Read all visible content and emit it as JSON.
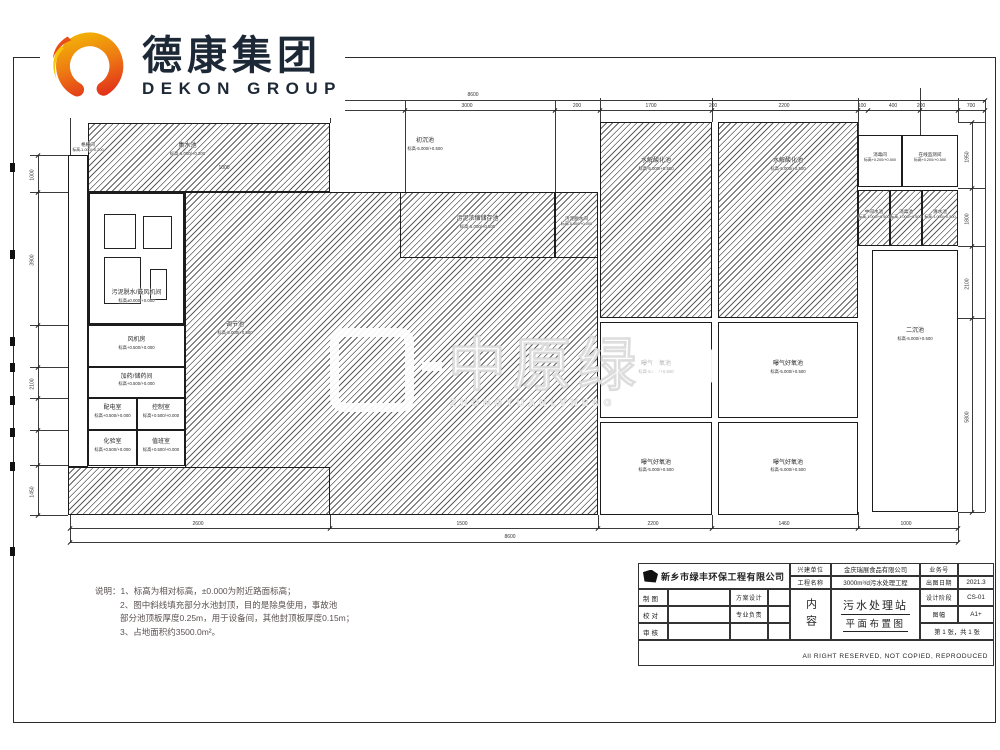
{
  "logo": {
    "cn": "德康集团",
    "en": "DEKON GROUP"
  },
  "watermark": {
    "big": "中原绿",
    "sub": "ZHONGYUANLVNENG"
  },
  "notes": {
    "line1": "说明：1、标高为相对标高，±0.000为附近路面标高；",
    "line2": "2、图中斜线填充部分水池封顶，目的是除臭使用，事故池",
    "line3": "部分池顶板厚度0.25m，用于设备间，其他封顶板厚度0.15m；",
    "line4": "3、占地面积约3500.0m²。"
  },
  "titleblock": {
    "design_company": "新乡市绿丰环保工程有限公司",
    "owner_label": "兴建单位",
    "owner_value": "金庆瑞展食品有限公司",
    "project_label": "工程名称",
    "project_value": "3000m³/d污水处理工程",
    "jobno_label": "业务号",
    "jobno_value": "",
    "date_label": "出图日期",
    "date_value": "2021.3",
    "draw_label": "制图",
    "check_label": "校对",
    "audit_label": "审核",
    "scheme_label": "方案设计",
    "major_label": "专业负责",
    "stage_label": "设计阶段",
    "stage_value": "CS-01",
    "size_label": "图幅",
    "size_value": "A1+",
    "sheet_value": "第 1 张，共 1 张",
    "content_label": "内容",
    "drawing_title1": "污水处理站",
    "drawing_title2": "平面布置图",
    "copyright": "All RIGHT RESERVED, NOT COPIED, REPRODUCED"
  },
  "plan": {
    "rooms": [
      {
        "id": "geshanjian",
        "name": "格栅间",
        "elev": "标高-1.000/+0.200",
        "box": [
          62,
          142,
          52,
          22
        ],
        "labelOnly": true,
        "small": true
      },
      {
        "id": "jishuichi",
        "name": "集水池",
        "elev": "标高-6.000/+0.200",
        "box": [
          88,
          123,
          242,
          69
        ],
        "hatch": true,
        "labelBox": [
          150,
          143,
          75,
          24
        ]
      },
      {
        "id": "wuni-tuoshui-room",
        "name": "污泥脱水/鼓风机间",
        "elev": "标高±0.000/+0.000",
        "box": [
          88,
          192,
          97,
          133
        ],
        "thick": true,
        "labelBox": [
          92,
          290,
          89,
          24
        ]
      },
      {
        "id": "fengjifang",
        "name": "风机房",
        "elev": "标高+0.500/+0.000",
        "box": [
          88,
          325,
          97,
          42
        ]
      },
      {
        "id": "jiayao",
        "name": "加药/储药间",
        "elev": "标高+0.500/+0.000",
        "box": [
          88,
          367,
          97,
          31
        ]
      },
      {
        "id": "peidianshi",
        "name": "配电室",
        "elev": "标高+0.500/+0.000",
        "box": [
          88,
          398,
          49,
          32
        ]
      },
      {
        "id": "kongzhishi",
        "name": "控制室",
        "elev": "标高+0.500/+0.000",
        "box": [
          137,
          398,
          48,
          32
        ]
      },
      {
        "id": "huayanshi",
        "name": "化验室",
        "elev": "标高+0.500/+0.000",
        "box": [
          88,
          430,
          49,
          36
        ]
      },
      {
        "id": "zhibanshi",
        "name": "值班室",
        "elev": "标高+0.500/+0.000",
        "box": [
          137,
          430,
          48,
          36
        ]
      },
      {
        "id": "tiaojiechi",
        "name": "调节池",
        "elev": "标高-5.000/+0.500",
        "box": [
          185,
          192,
          413,
          323
        ],
        "hatch": true,
        "labelBox": [
          195,
          322,
          80,
          24
        ]
      },
      {
        "id": "chuchenchi",
        "name": "初沉池",
        "elev": "标高-5.000/+0.500",
        "box": [
          385,
          138,
          80,
          24
        ],
        "labelOnly": true
      },
      {
        "id": "nongsuochi",
        "name": "污泥浓缩储存池",
        "elev": "标高-5.000/+0.500",
        "box": [
          400,
          192,
          155,
          66
        ],
        "hatch": true
      },
      {
        "id": "tuoshuijian",
        "name": "污泥脱水间",
        "elev": "标高-5.000/+0.000",
        "box": [
          555,
          192,
          43,
          66
        ],
        "hatch": true,
        "small": true
      },
      {
        "id": "shuijie1",
        "name": "水解酸化池",
        "elev": "标高-5.000/+0.500",
        "box": [
          600,
          122,
          112,
          196
        ],
        "hatch": true,
        "labelBox": [
          615,
          158,
          82,
          24
        ]
      },
      {
        "id": "shuijie2",
        "name": "水解酸化池",
        "elev": "标高-5.000/+0.500",
        "box": [
          718,
          122,
          140,
          196
        ],
        "hatch": true,
        "labelBox": [
          745,
          158,
          86,
          24
        ]
      },
      {
        "id": "haoyang1",
        "name": "曝气好氧池",
        "elev": "标高-5.000/+0.500",
        "box": [
          600,
          322,
          112,
          96
        ],
        "faded": true
      },
      {
        "id": "haoyang2",
        "name": "曝气好氧池",
        "elev": "标高-5.000/+0.500",
        "box": [
          718,
          322,
          140,
          96
        ]
      },
      {
        "id": "haoyang3",
        "name": "曝气好氧池",
        "elev": "标高-5.000/+0.500",
        "box": [
          600,
          422,
          112,
          93
        ]
      },
      {
        "id": "haoyang4",
        "name": "曝气好氧池",
        "elev": "标高-5.000/+0.500",
        "box": [
          718,
          422,
          140,
          93
        ]
      },
      {
        "id": "xiaodujian",
        "name": "消毒间",
        "elev": "标高+0.200/+0.500",
        "box": [
          858,
          135,
          44,
          52
        ],
        "small": true
      },
      {
        "id": "zaixianjiance",
        "name": "在线监测间",
        "elev": "标高+0.200/+0.500",
        "box": [
          902,
          135,
          56,
          52
        ],
        "small": true
      },
      {
        "id": "zhongjianshuichi",
        "name": "中间水池",
        "elev": "标高-1.000/+0.500",
        "box": [
          858,
          190,
          32,
          56
        ],
        "hatch": true,
        "small": true
      },
      {
        "id": "xiaoduchi",
        "name": "消毒池",
        "elev": "标高-1.000/+0.500",
        "box": [
          890,
          190,
          32,
          56
        ],
        "hatch": true,
        "small": true
      },
      {
        "id": "qingshuichi",
        "name": "清水池",
        "elev": "标高-1.000/+0.500",
        "box": [
          922,
          190,
          36,
          56
        ],
        "hatch": true,
        "small": true
      },
      {
        "id": "erchenchi",
        "name": "二沉池",
        "elev": "标高-5.000/+0.500",
        "box": [
          872,
          250,
          86,
          262
        ],
        "labelBox": [
          878,
          328,
          74,
          24
        ]
      },
      {
        "id": "hatch-strip-bottom",
        "name": "",
        "elev": "",
        "box": [
          68,
          467,
          262,
          48
        ],
        "hatch": true
      },
      {
        "id": "geshan-strip",
        "name": "",
        "elev": "",
        "box": [
          68,
          155,
          20,
          312
        ]
      }
    ],
    "equipment": [
      [
        104,
        214,
        30,
        33
      ],
      [
        143,
        216,
        27,
        31
      ],
      [
        104,
        257,
        35,
        45
      ],
      [
        150,
        269,
        15,
        29
      ]
    ],
    "lines": [
      [
        70,
        98,
        57,
        "v"
      ],
      [
        330,
        98,
        25,
        "v"
      ],
      [
        405,
        100,
        92,
        "v"
      ],
      [
        555,
        100,
        92,
        "v"
      ],
      [
        600,
        98,
        24,
        "v"
      ],
      [
        712,
        98,
        24,
        "v"
      ],
      [
        858,
        98,
        37,
        "v"
      ],
      [
        920,
        88,
        47,
        "v"
      ],
      [
        958,
        98,
        24,
        "v"
      ],
      [
        70,
        515,
        27,
        "v"
      ],
      [
        330,
        515,
        13,
        "v"
      ],
      [
        598,
        515,
        13,
        "v"
      ],
      [
        712,
        515,
        13,
        "v"
      ],
      [
        858,
        512,
        16,
        "v"
      ],
      [
        958,
        512,
        30,
        "v"
      ],
      [
        70,
        100,
        915,
        "h"
      ],
      [
        330,
        110,
        655,
        "h"
      ],
      [
        70,
        528,
        888,
        "h"
      ],
      [
        70,
        542,
        888,
        "h"
      ],
      [
        30,
        155,
        38,
        "h"
      ],
      [
        30,
        192,
        38,
        "h"
      ],
      [
        30,
        325,
        38,
        "h"
      ],
      [
        30,
        367,
        38,
        "h"
      ],
      [
        30,
        398,
        38,
        "h"
      ],
      [
        30,
        430,
        38,
        "h"
      ],
      [
        30,
        465,
        38,
        "h"
      ],
      [
        30,
        515,
        38,
        "h"
      ],
      [
        38,
        155,
        360,
        "v"
      ],
      [
        972,
        122,
        390,
        "v"
      ],
      [
        958,
        122,
        27,
        "h"
      ],
      [
        958,
        188,
        27,
        "h"
      ],
      [
        958,
        246,
        27,
        "h"
      ],
      [
        958,
        318,
        27,
        "h"
      ],
      [
        958,
        512,
        27,
        "h"
      ],
      [
        985,
        100,
        412,
        "v"
      ]
    ],
    "ticks": [
      [
        330,
        110
      ],
      [
        405,
        110
      ],
      [
        555,
        110
      ],
      [
        600,
        110
      ],
      [
        712,
        110
      ],
      [
        858,
        110
      ],
      [
        868,
        110
      ],
      [
        920,
        110
      ],
      [
        958,
        110
      ],
      [
        985,
        110
      ],
      [
        70,
        100
      ],
      [
        985,
        100
      ],
      [
        70,
        528
      ],
      [
        330,
        528
      ],
      [
        598,
        528
      ],
      [
        712,
        528
      ],
      [
        858,
        528
      ],
      [
        958,
        528
      ],
      [
        70,
        542
      ],
      [
        958,
        542
      ],
      [
        38,
        155
      ],
      [
        38,
        192
      ],
      [
        38,
        325
      ],
      [
        38,
        367
      ],
      [
        38,
        398
      ],
      [
        38,
        430
      ],
      [
        38,
        465
      ],
      [
        38,
        515
      ],
      [
        972,
        122
      ],
      [
        972,
        188
      ],
      [
        972,
        246
      ],
      [
        972,
        318
      ],
      [
        972,
        512
      ]
    ],
    "dims": {
      "top_overall": {
        "t": "8600",
        "x": 473,
        "y": 92
      },
      "top": [
        [
          "3000",
          467
        ],
        [
          "200",
          577
        ],
        [
          "1700",
          651
        ],
        [
          "200",
          713
        ],
        [
          "2200",
          784
        ],
        [
          "100",
          862
        ],
        [
          "400",
          893
        ],
        [
          "200",
          921
        ],
        [
          "700",
          971
        ]
      ],
      "top_y": 103,
      "bottom": [
        [
          "2600",
          198
        ],
        [
          "1500",
          462
        ],
        [
          "2200",
          653
        ],
        [
          "1460",
          784
        ],
        [
          "1000",
          906
        ]
      ],
      "bottom_y": 521,
      "bottom_overall": {
        "t": "8600",
        "x": 510,
        "y": 534
      },
      "left": [
        [
          "1000",
          172
        ],
        [
          "3900",
          257
        ],
        [
          "2100",
          381
        ],
        [
          "1450",
          489
        ]
      ],
      "left_x": 27,
      "right": [
        [
          "1950",
          154
        ],
        [
          "1800",
          216
        ],
        [
          "2100",
          281
        ],
        [
          "5800",
          414
        ]
      ],
      "right_x": 962,
      "inner": [
        [
          "1000",
          224,
          165
        ]
      ]
    },
    "squares": [
      [
        10,
        163
      ],
      [
        10,
        250
      ],
      [
        10,
        337
      ],
      [
        10,
        363
      ],
      [
        10,
        396
      ],
      [
        10,
        428
      ],
      [
        10,
        462
      ],
      [
        10,
        547
      ]
    ]
  }
}
